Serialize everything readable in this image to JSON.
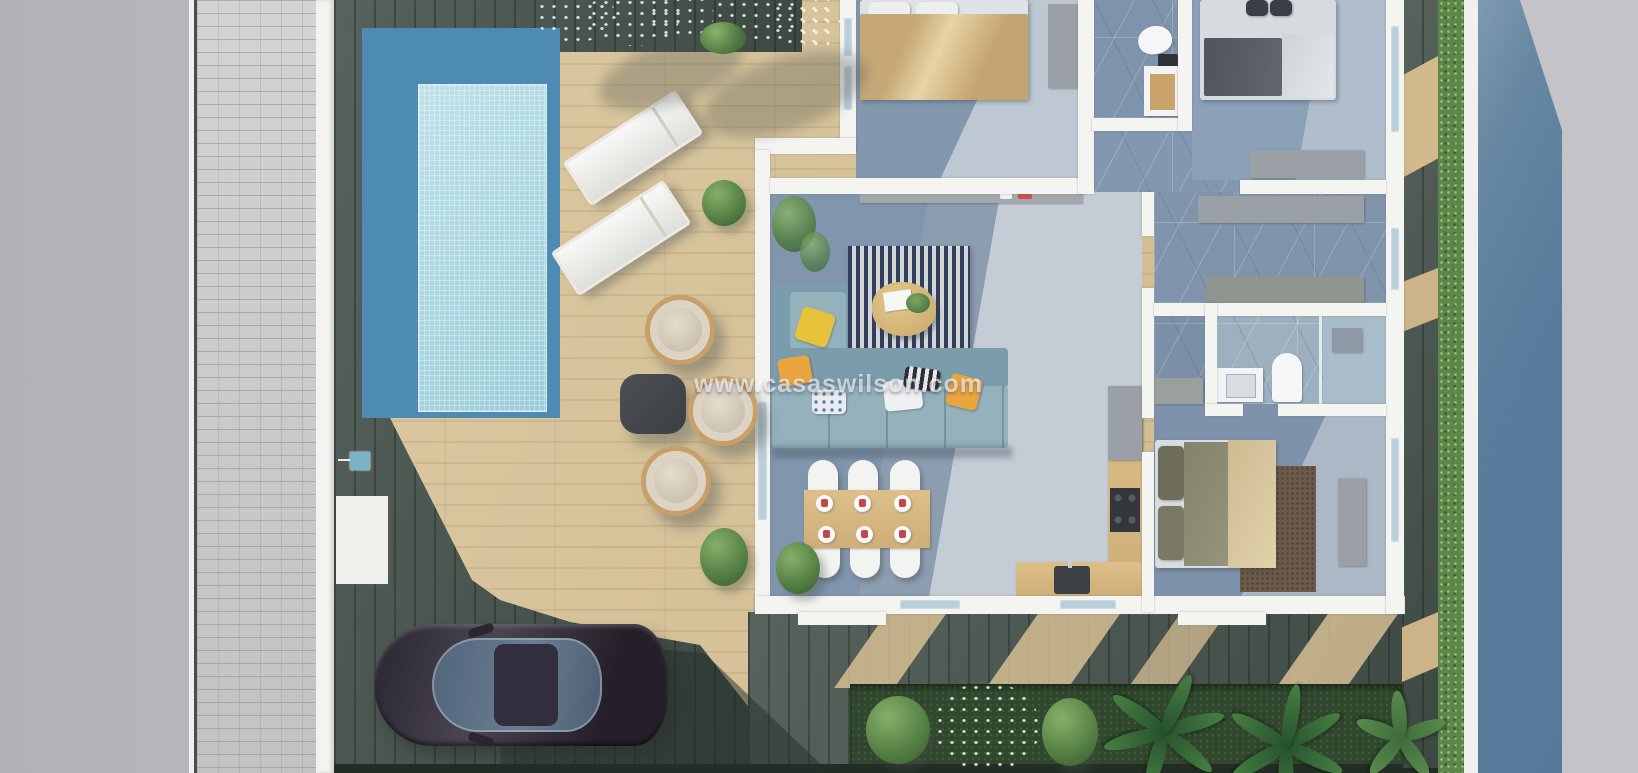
{
  "watermark": {
    "text": "www.casaswilson.com"
  },
  "palette": {
    "street_left_gray": "#b5b4b9",
    "sidewalk_cobble": "#cdccce",
    "deck_light_wood": "#d8c397",
    "deck_dark_wood": "#4d5953",
    "pool_border_blue": "#4d8bb4",
    "pool_water": "#a8d7e1",
    "hedge_green": "#5d8748",
    "garden_grass": "#31462e",
    "road_blue": "#56799a",
    "road_gray": "#c4c4c8",
    "house_wall_white": "#f4f4f1",
    "marble_shadow": "#7e93a9",
    "marble_light": "#ccd1d8",
    "sofa_blue": "#93b2bc",
    "accent_yellow": "#e8c23a",
    "car_body": "#332e3b"
  },
  "scene": {
    "type": "aerial-3d-floorplan-render",
    "areas": [
      "street",
      "sidewalk",
      "pool",
      "sun-deck",
      "terrace",
      "living-room",
      "dining-area",
      "kitchen",
      "bedroom-1",
      "bathroom-1",
      "bedroom-2",
      "dressing-area",
      "ensuite-bathroom",
      "bedroom-3",
      "driveway",
      "garden",
      "hedge"
    ],
    "furniture": [
      "sun-loungers",
      "wicker-chairs",
      "side-table",
      "corner-sofa",
      "striped-rug",
      "coffee-table",
      "dining-table",
      "dining-chairs",
      "double-beds",
      "wardrobes",
      "kitchen-counter",
      "car"
    ]
  }
}
